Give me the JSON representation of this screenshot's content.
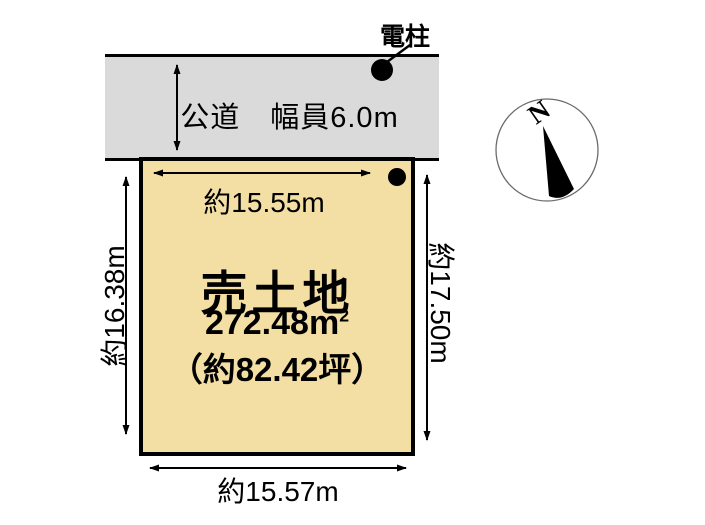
{
  "diagram": {
    "background": "#ffffff",
    "ink": "#000000",
    "road": {
      "label": "公道　幅員6.0m",
      "fill": "#dadada"
    },
    "pole": {
      "label": "電柱"
    },
    "parcel": {
      "title": "売土地",
      "area": "272.48m",
      "area_exponent": "2",
      "area_tsubo": "（約82.42坪）",
      "fill": "#f3dfa4",
      "dimensions": {
        "top": "約15.55m",
        "bottom": "約15.57m",
        "left": "約16.38m",
        "right": "約17.50m"
      }
    },
    "compass": {
      "north_label": "N"
    }
  }
}
